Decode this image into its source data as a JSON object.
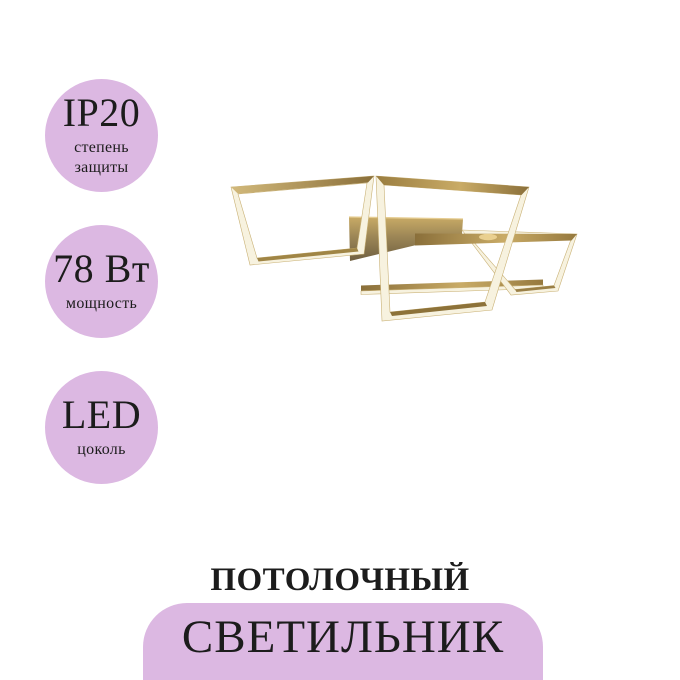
{
  "badges": [
    {
      "value": "IP20",
      "label_lines": [
        "степень",
        "защиты"
      ]
    },
    {
      "value": "78 Вт",
      "label_lines": [
        "мощность"
      ]
    },
    {
      "value": "LED",
      "label_lines": [
        "цоколь"
      ]
    }
  ],
  "title": {
    "line1": "ПОТОЛОЧНЫЙ",
    "line2": "СВЕТИЛЬНИК"
  },
  "colors": {
    "background": "#ffffff",
    "accent_lavender": "#dcb8e2",
    "text_dark": "#1c1c1c",
    "gold_light": "#d2b97b",
    "gold_mid": "#c9ab66",
    "gold_dark": "#8a6f3a",
    "cream_led": "#f7f2df",
    "plate_dark": "#6f5f40"
  },
  "product_image": {
    "name": "gold-square-led-ceiling-light"
  }
}
